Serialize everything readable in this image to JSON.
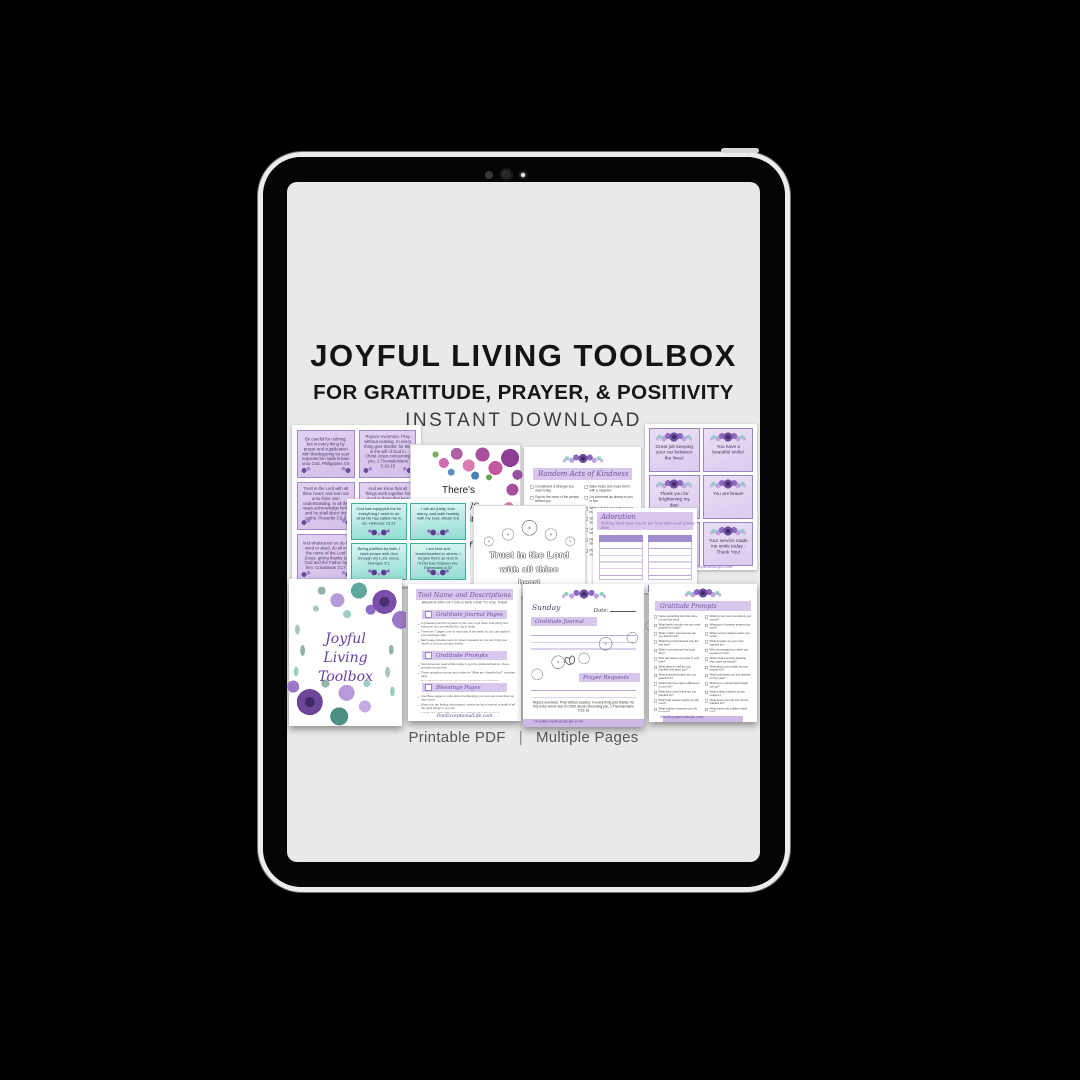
{
  "header": {
    "title": "JOYFUL LIVING TOOLBOX",
    "subtitle": "FOR GRATITUDE, PRAYER, & POSITIVITY",
    "tagline": "INSTANT DOWNLOAD"
  },
  "footer": {
    "format": "Printable PDF",
    "separator": "|",
    "pages": "Multiple Pages"
  },
  "colors": {
    "accent_purple": "#7b5fae",
    "banner_lavender": "#d9c6ec",
    "card_purple": "#dcc9ee",
    "card_teal": "#9adfd6",
    "screen_gray": "#e9e9e9"
  },
  "collage": {
    "scripture_cards": {
      "site": "OneExceptionalLife.com",
      "cards": [
        "Be careful for nothing; but in every thing by prayer and supplication with thanksgiving let your requests be made known unto God. Philippians 4:6",
        "Rejoice evermore. Pray without ceasing. In every thing give thanks: for this is the will of God in Christ Jesus concerning you. 1 Thessalonians 5:16-18",
        "Trust in the Lord with all thine heart; and lean not unto thine own understanding. In all thy ways acknowledge him, and he shall direct thy paths. Proverbs 3:5-6",
        "And we know that all things work together for good to them that love God, to them who are the called according to his purpose. Romans 8:28",
        "And whatsoever ye do in word or deed, do all in the name of the Lord Jesus, giving thanks to God and the Father by him. Colossians 3:17",
        ""
      ]
    },
    "poster": {
      "lines": [
        "There's",
        "always",
        "something",
        "to be",
        "thankful"
      ]
    },
    "kindness": {
      "title": "Random Acts of Kindness",
      "items_left": [
        "Compliment a stranger you meet today",
        "Pay for the order of the person behind you",
        "Leave a kind note in a library book",
        "Hold the door open for someone",
        "Donate gently used items to charity",
        "Text an encouraging verse to a friend"
      ],
      "items_right": [
        "Bake treats and share them with a neighbor",
        "Let someone go ahead of you in line",
        "Write a thank you note to your mail carrier",
        "Smile at everyone you pass today",
        "Leave a generous tip with a kind note",
        "Return a stray shopping cart for someone",
        "Pick up litter in your neighborhood"
      ]
    },
    "compliment_cards": {
      "site": "OneExceptionalLife.com",
      "cards": [
        "Great job keeping your car between the lines!",
        "You have a beautiful smile!",
        "Thank you for brightening my day!",
        "You are brave!",
        "",
        "Your service made me smile today - Thank You!"
      ]
    },
    "affirmation_cards": {
      "cards": [
        "God has equipped me for everything I need to do what He has called me to do. Hebrews 13:21",
        "I will act justly, love mercy, and walk humbly with my God. Micah 6:8",
        "Being justified by faith, I have peace with God through my Lord Jesus. Romans 5:1",
        "I am kind and tenderhearted to others. I forgive them as God in Christ has forgiven me. Ephesians 4:32"
      ]
    },
    "coloring": {
      "lines": [
        "Trust in the Lord",
        "with all thine",
        "heart"
      ]
    },
    "adoration": {
      "title": "Adoration",
      "subtitle": "Telling God how much we love Him and praise Him"
    },
    "cover": {
      "lines": [
        "Joyful",
        "Living",
        "Toolbox"
      ]
    },
    "tools": {
      "title": "Tool Name and Descriptions",
      "subtitle": "BREAKDOWN OF TOOLS AND HOW TO USE THEM",
      "site": "OneExceptionalLife.com",
      "sections": [
        {
          "heading": "Gratitude Journal Pages",
          "bullets": [
            "A gratitude journal is a place of your own to jot down everything and everyone you are thankful for, big or small.",
            "There are 7 pages, one for each day of the week, so you can capture your blessings daily.",
            "Each page includes room for prayer requests so you can bring your needs to God as you give thanks."
          ]
        },
        {
          "heading": "Gratitude Prompts",
          "bullets": [
            "Sometimes we need a little nudge to get the gratitude flowing - these prompts do just that.",
            "These questions prompt and make the \"What am I thankful for?\" exercise easy.",
            "Over 25 prompts to help you get your gratitude juices flowing."
          ]
        },
        {
          "heading": "Blessings Pages",
          "bullets": [
            "Use these pages to write down the blessings you see and count them as they come.",
            "When you are feeling discouraged, review the list to remind yourself of all the good things in your life.",
            "A habit of counting blessings turns ordinary days into days of thanksgiving."
          ]
        }
      ]
    },
    "journal": {
      "day": "Sunday",
      "date_label": "Date:",
      "section1": "Gratitude Journal",
      "section2": "Prayer Requests",
      "verse": "Rejoice evermore. Pray without ceasing. In every thing give thanks: for this is the will of God in Christ Jesus concerning you. 1 Thessalonians 5:16-18",
      "site": "OneExceptionalLife.com"
    },
    "prompts": {
      "title": "Gratitude Prompts",
      "site": "OneExceptionalLife.com",
      "items_left": [
        "Name something God has done for you this week",
        "What family member are you most grateful for today?",
        "What modern convenience are you thankful for?",
        "What friend has blessed your life and how?",
        "What is your favorite food and why?",
        "Who has helped you grow in your faith?",
        "What talent or skill are you thankful God gave you?",
        "What answered prayer are you grateful for?",
        "What book has made a difference in your life?",
        "What about your home are you thankful for?",
        "What hard season taught you the most?",
        "What teacher impacted your life for good?",
        "What song lifts your spirits every time?"
      ],
      "items_right": [
        "What do you love most about your church?",
        "What part of creation amazes you most?",
        "What memory always makes you smile?",
        "What freedom are you most thankful for?",
        "Who encouraged you when you needed it most?",
        "What small everyday blessing often goes unnoticed?",
        "What about your health are you grateful for?",
        "What opportunity are you thankful for this year?",
        "What pet or animal has brought you joy?",
        "What holiday tradition do you treasure?",
        "What about your job can you be thankful for?",
        "What lesson did a failure teach you?",
        "Who can you thank in person this week?"
      ]
    }
  }
}
